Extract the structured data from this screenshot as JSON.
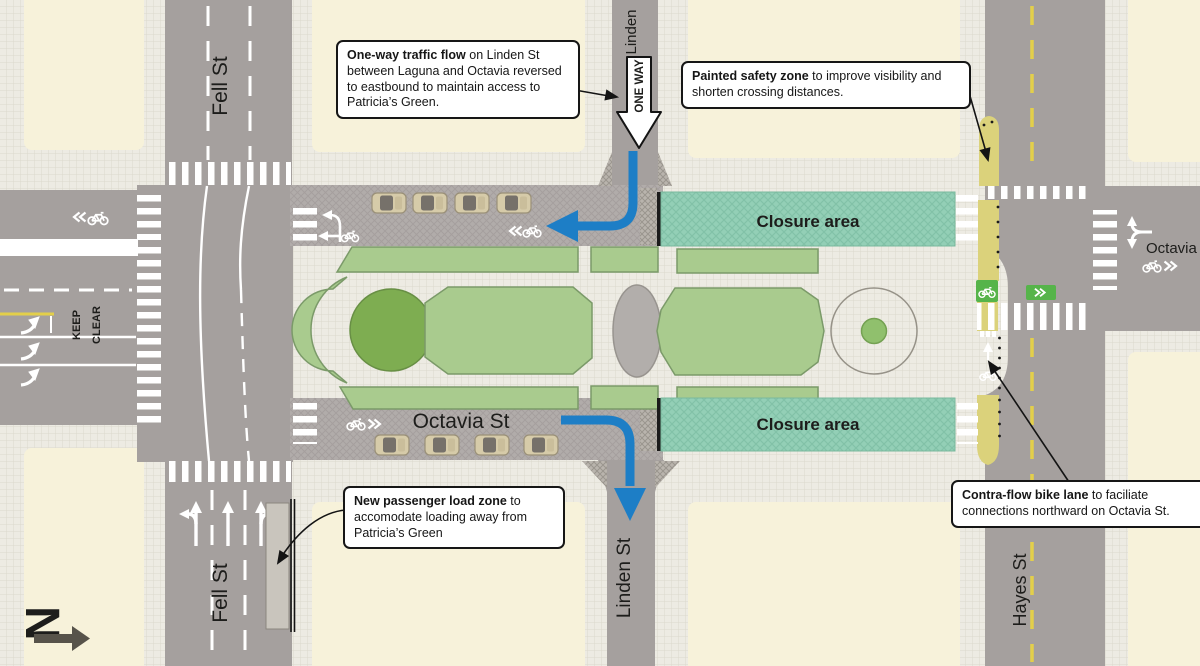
{
  "callouts": {
    "one_way": {
      "lead": "One-way traffic flow",
      "body": " on Linden St between Laguna and Octavia reversed to eastbound to maintain access to Patricia’s Green."
    },
    "safety_zone": {
      "lead": "Painted safety zone",
      "body": " to improve visibility and shorten crossing distances."
    },
    "load_zone": {
      "lead": "New passenger load zone",
      "body": " to accomodate loading away from Patricia’s Green"
    },
    "contraflow": {
      "lead": "Contra-flow bike lane",
      "body": " to faciliate connections northward on Octavia St."
    }
  },
  "street_labels": {
    "fell_top": "Fell St",
    "fell_bottom": "Fell St",
    "linden_top": "Linden",
    "linden_bottom": "Linden St",
    "hayes": "Hayes St",
    "octavia_median": "Octavia St",
    "octavia_east": "Octavia"
  },
  "areas": {
    "closure_top": "Closure area",
    "closure_bottom": "Closure area"
  },
  "road_markings": {
    "one_way_sign": "ONE WAY",
    "keep_clear_word1": "KEEP",
    "keep_clear_word2": "CLEAR"
  },
  "compass": {
    "north": "N"
  },
  "colors": {
    "road_gray": "#a5a09e",
    "sidewalk": "#edebe3",
    "block_cream": "#f7f2da",
    "closure_teal": "#93cfb6",
    "park_green": "#a9cb8e",
    "park_dark_green": "#7ead51",
    "flow_blue": "#1d7ec6",
    "paint_yellow": "#e3cf4a",
    "safety_zone_yellow": "#dbd27b",
    "bike_lane_green": "#56b44a",
    "car_tan": "#d6cba9"
  }
}
